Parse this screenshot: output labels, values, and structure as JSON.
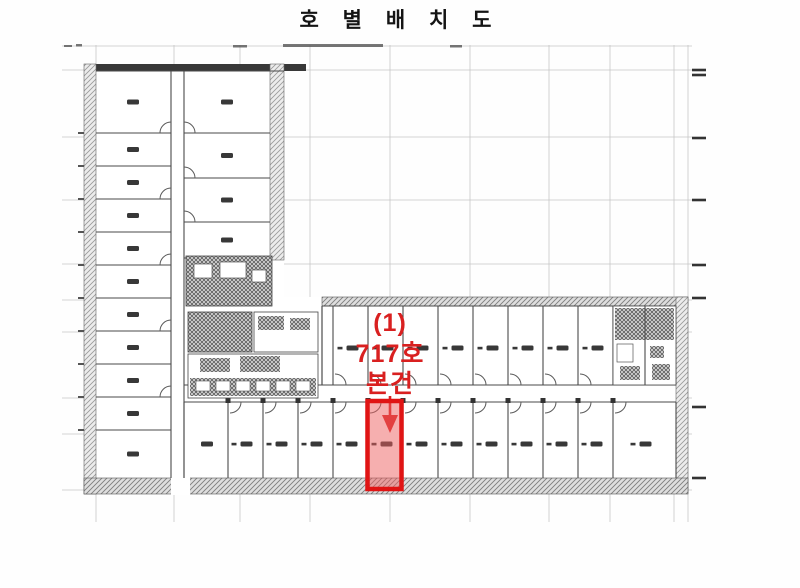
{
  "document": {
    "type": "scanned-floor-plan",
    "title": "호 별 배 치 도"
  },
  "annotation": {
    "index": "(1)",
    "unit": "717호",
    "subject": "본건",
    "color": "#d92020"
  },
  "highlight": {
    "border_color": "#e01414",
    "fill_color": "#ee5f5f"
  },
  "colors": {
    "drawing_line": "#3a3a3a",
    "grid_line": "#c6c6c6",
    "background": "#fefefe"
  }
}
